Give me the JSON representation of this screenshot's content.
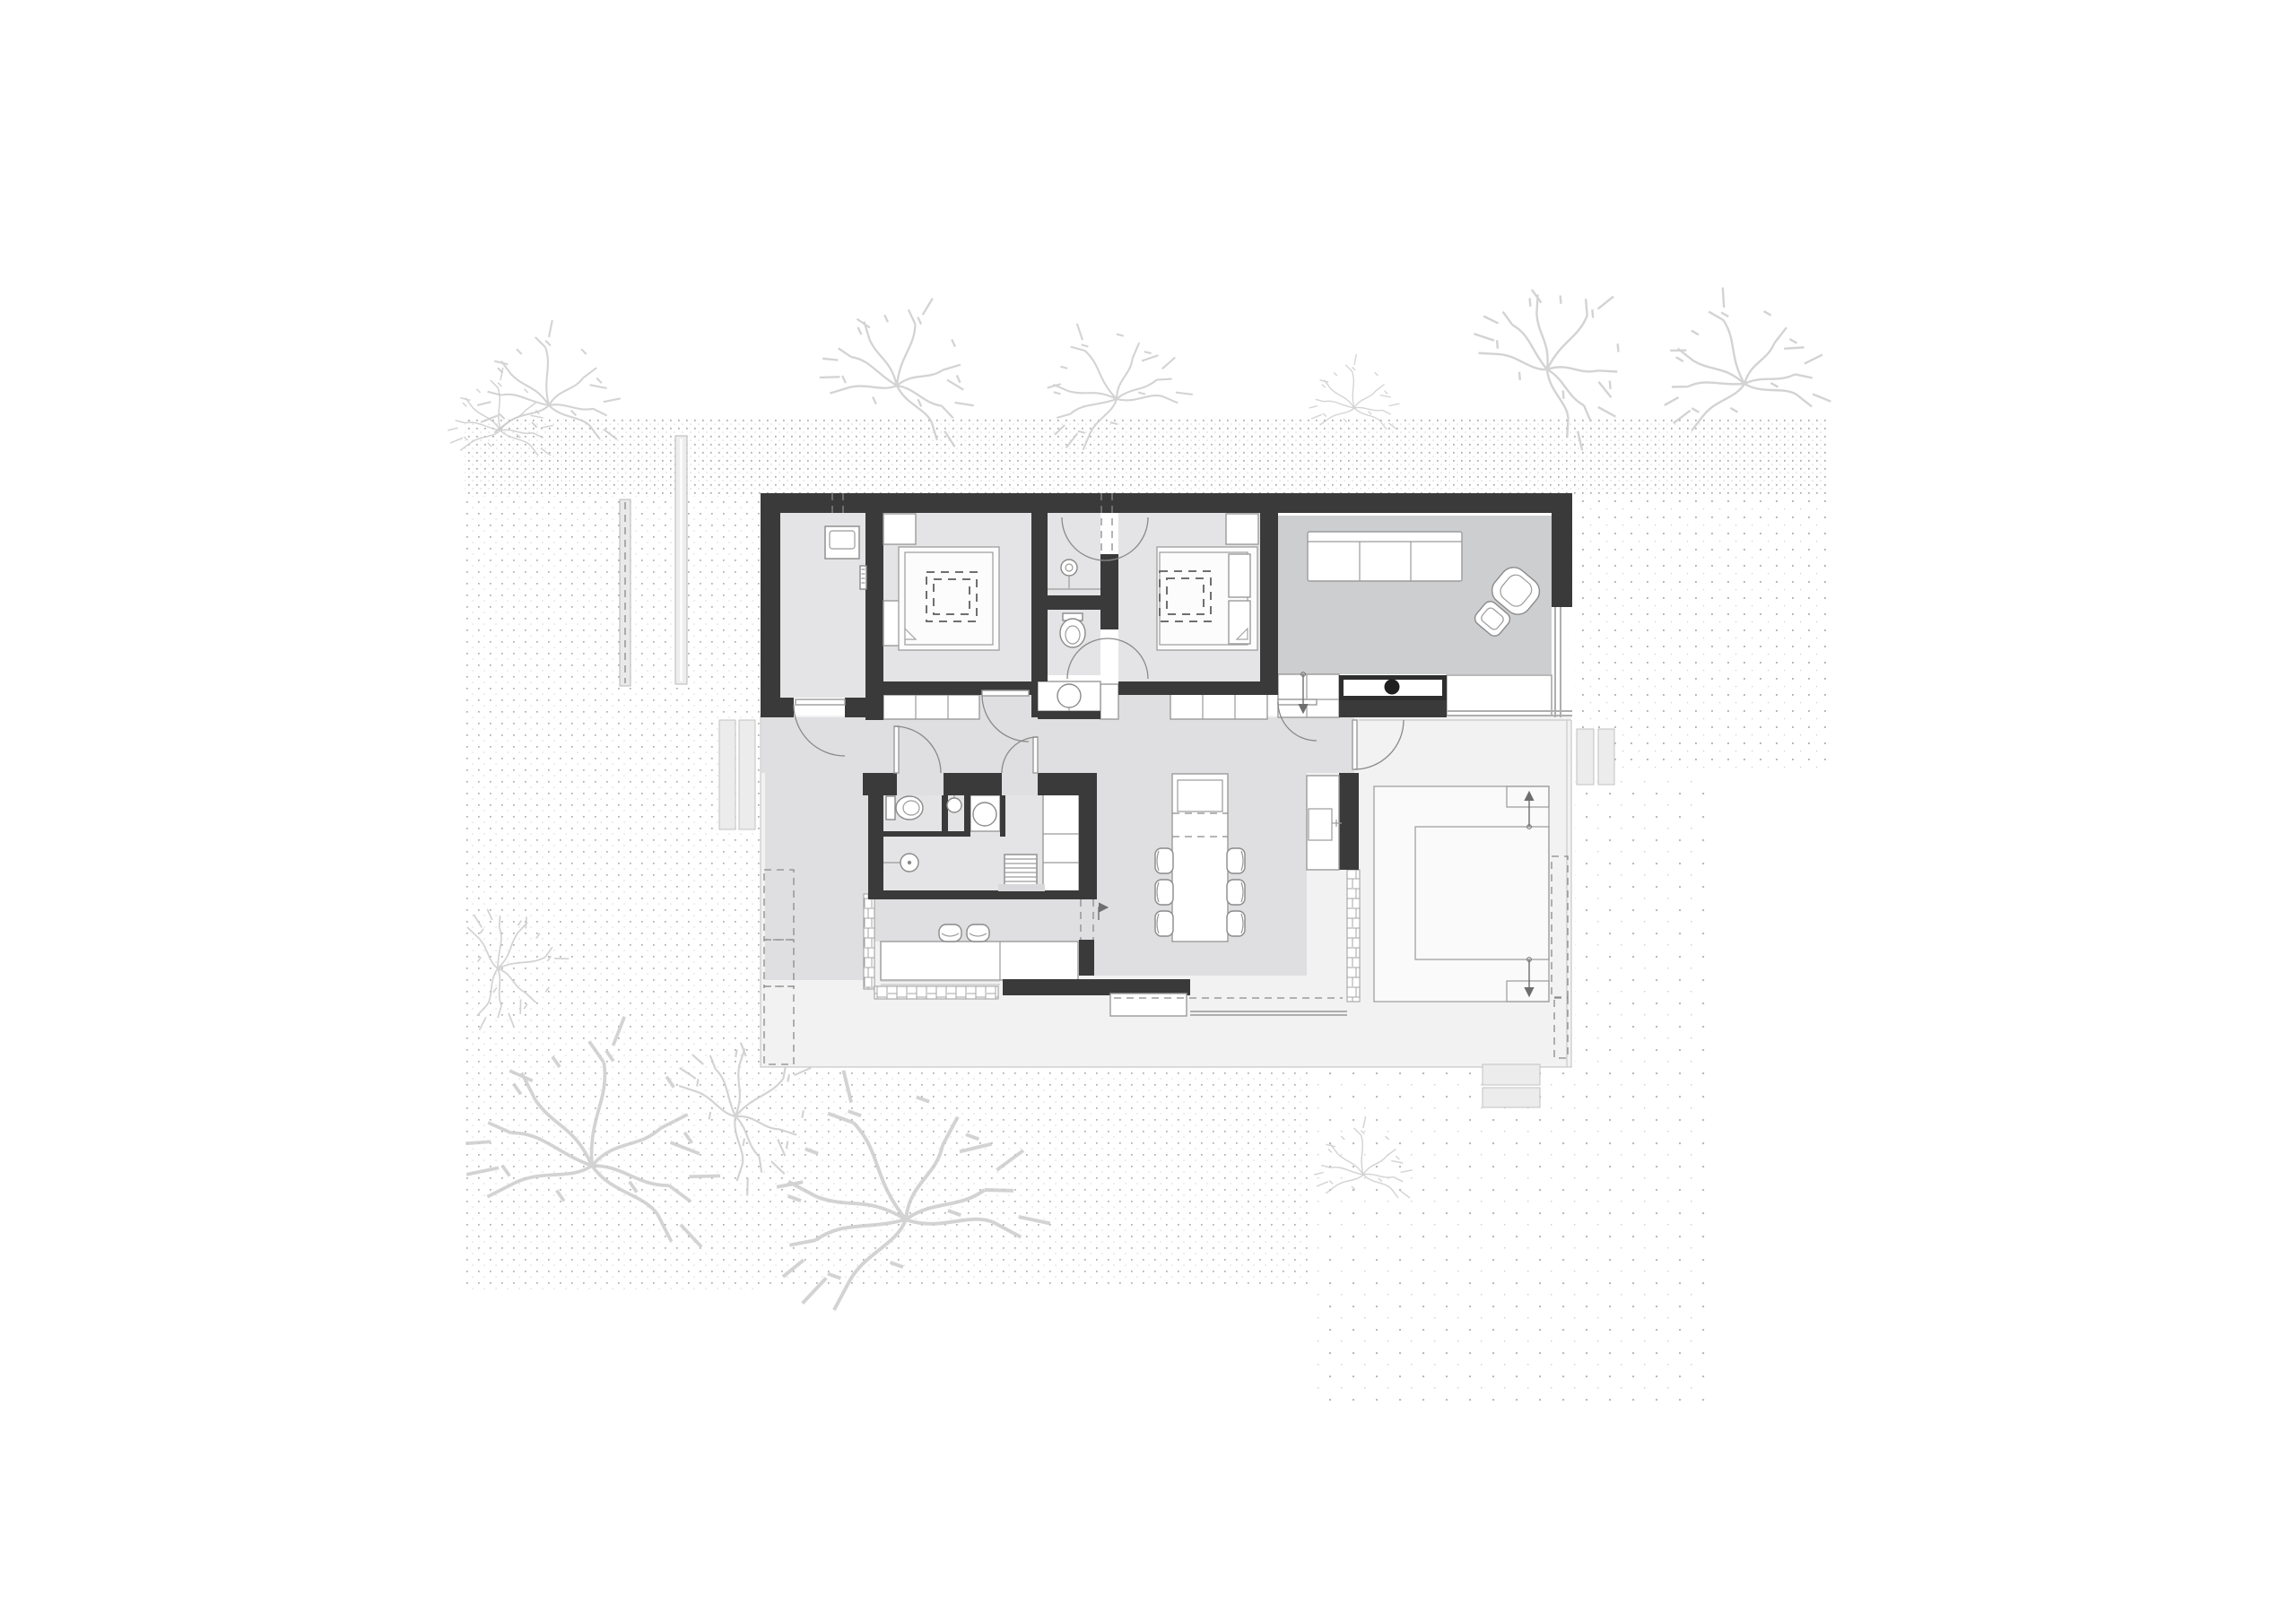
{
  "document": {
    "kind": "architectural-floor-plan",
    "style": "black-and-white line drawing with dotted site texture",
    "aria_label": "Ground floor plan of a house with surrounding terraces, gravel dot texture and sketched trees",
    "visible_text": []
  },
  "palette": {
    "background": "#ffffff",
    "walls": "#3a3a3a",
    "floor_rooms": "#e4e4e6",
    "floor_hall_dining": "#dfdfe1",
    "floor_living": "#cdced0",
    "patio": "#f2f2f3",
    "platform": "#fafafb",
    "furniture_stroke": "#9b9b9b",
    "dots": "#9e9e9e",
    "trees": "#cccccc",
    "accents_dark": "#1f1f1f"
  },
  "rooms": [
    {
      "name": "entry-utility-room"
    },
    {
      "name": "bedroom-1"
    },
    {
      "name": "bathroom-upper"
    },
    {
      "name": "wc-upper"
    },
    {
      "name": "bedroom-2"
    },
    {
      "name": "living-room"
    },
    {
      "name": "hallway"
    },
    {
      "name": "wc-lower"
    },
    {
      "name": "shower-room"
    },
    {
      "name": "dining-kitchen-area"
    },
    {
      "name": "covered-outdoor-bench-area"
    },
    {
      "name": "terrace-walkway"
    },
    {
      "name": "terrace-platform"
    }
  ],
  "furniture": [
    {
      "name": "washing-machine",
      "room": "entry-utility-room"
    },
    {
      "name": "double-bed-1",
      "room": "bedroom-1"
    },
    {
      "name": "double-bed-2",
      "room": "bedroom-2"
    },
    {
      "name": "wardrobe-cells",
      "count": 3,
      "room": "bedroom-1"
    },
    {
      "name": "wardrobe-cells",
      "count": 3,
      "room": "bedroom-2"
    },
    {
      "name": "pedestal-basin",
      "room": "bathroom-upper"
    },
    {
      "name": "toilet",
      "room": "wc-upper"
    },
    {
      "name": "vanity-basin",
      "room": "hallway"
    },
    {
      "name": "sofa-3-seat",
      "room": "living-room"
    },
    {
      "name": "armchair",
      "room": "living-room"
    },
    {
      "name": "ottoman",
      "room": "living-room"
    },
    {
      "name": "fireplace-stove-block",
      "room": "living-room"
    },
    {
      "name": "kitchen-counter",
      "room": "dining-kitchen-area"
    },
    {
      "name": "dining-island-table",
      "room": "dining-kitchen-area"
    },
    {
      "name": "dining-chairs",
      "count": 6,
      "room": "dining-kitchen-area"
    },
    {
      "name": "outdoor-sink-counter",
      "room": "terrace-walkway"
    },
    {
      "name": "toilet",
      "room": "wc-lower"
    },
    {
      "name": "wall-basin",
      "room": "wc-lower"
    },
    {
      "name": "washbasin-counter",
      "room": "shower-room"
    },
    {
      "name": "shower-head",
      "room": "shower-room"
    },
    {
      "name": "towel-ladder",
      "room": "shower-room"
    },
    {
      "name": "tall-cabinet",
      "room": "shower-room"
    },
    {
      "name": "outdoor-bench",
      "room": "covered-outdoor-bench-area"
    },
    {
      "name": "stools",
      "count": 2,
      "room": "covered-outdoor-bench-area"
    }
  ],
  "site_elements": [
    {
      "name": "dotted-gravel-texture-zones",
      "count": 6
    },
    {
      "name": "sketched-trees",
      "count": 11
    },
    {
      "name": "fence-strips",
      "count": 2
    },
    {
      "name": "entrance-planks",
      "count": 2
    },
    {
      "name": "dashed-planters",
      "count": 2
    },
    {
      "name": "brick-paving-strips",
      "count": 3
    },
    {
      "name": "terrace-steps",
      "count": 2
    },
    {
      "name": "section-arrows",
      "count": 3
    }
  ]
}
